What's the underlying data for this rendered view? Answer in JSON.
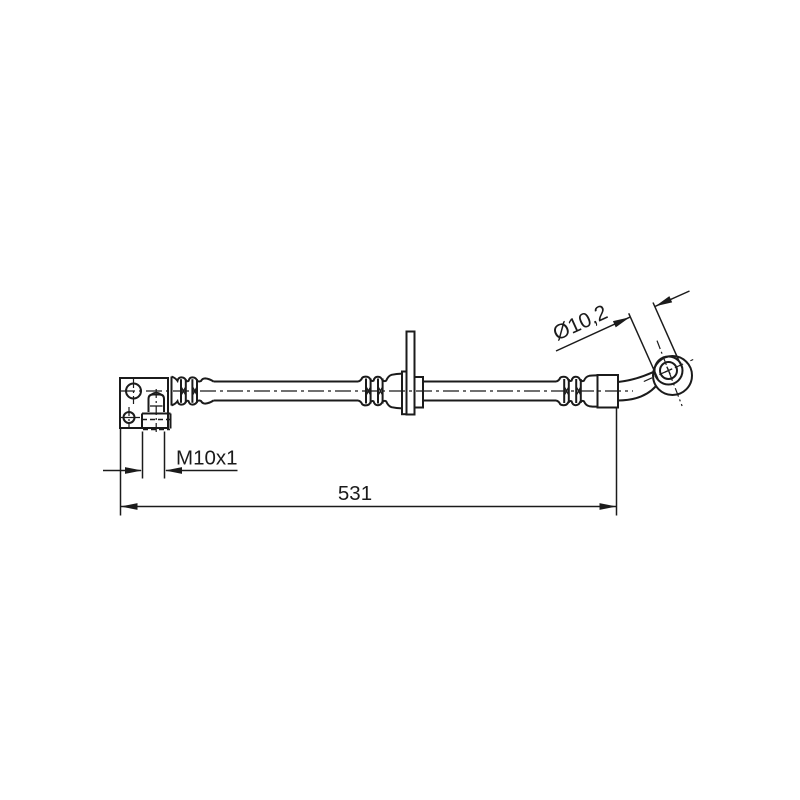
{
  "drawing": {
    "background_color": "#ffffff",
    "line_color": "#1b1b1b",
    "dimensions": {
      "diameter_label": "Ø10,2",
      "thread_label": "M10x1",
      "length_label": "531"
    }
  }
}
